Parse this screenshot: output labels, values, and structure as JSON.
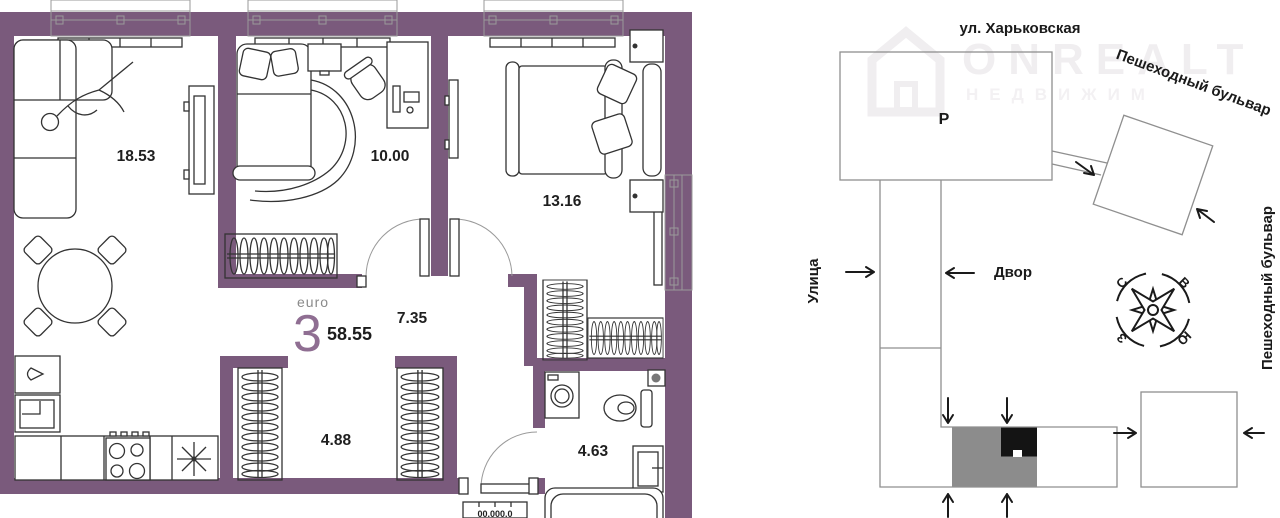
{
  "floor_plan": {
    "unit_type_label": "euro",
    "unit_rooms": "3",
    "unit_area": "58.55",
    "room_areas": {
      "living_room": "18.53",
      "bedroom_small": "10.00",
      "bedroom_large": "13.16",
      "hall": "7.35",
      "corridor": "4.88",
      "bathroom": "4.63"
    },
    "entrance_mark": "00.000.0",
    "wall_color": "#7a5a7c"
  },
  "site_plan": {
    "street_top": "ул. Харьковская",
    "boulevard_diagonal": "Пешеходный бульвар",
    "boulevard_right": "Пешеходный бульвар",
    "street_left": "Улица",
    "courtyard": "Двор",
    "parking": "Р",
    "compass": {
      "north": "С",
      "east": "В",
      "west": "З",
      "south": "Ю"
    },
    "building_fill_gray": "#8c8c8c",
    "building_fill_black": "#141414"
  },
  "watermark": {
    "brand": "ONREALT",
    "subtitle": "НЕДВИЖИМ"
  }
}
